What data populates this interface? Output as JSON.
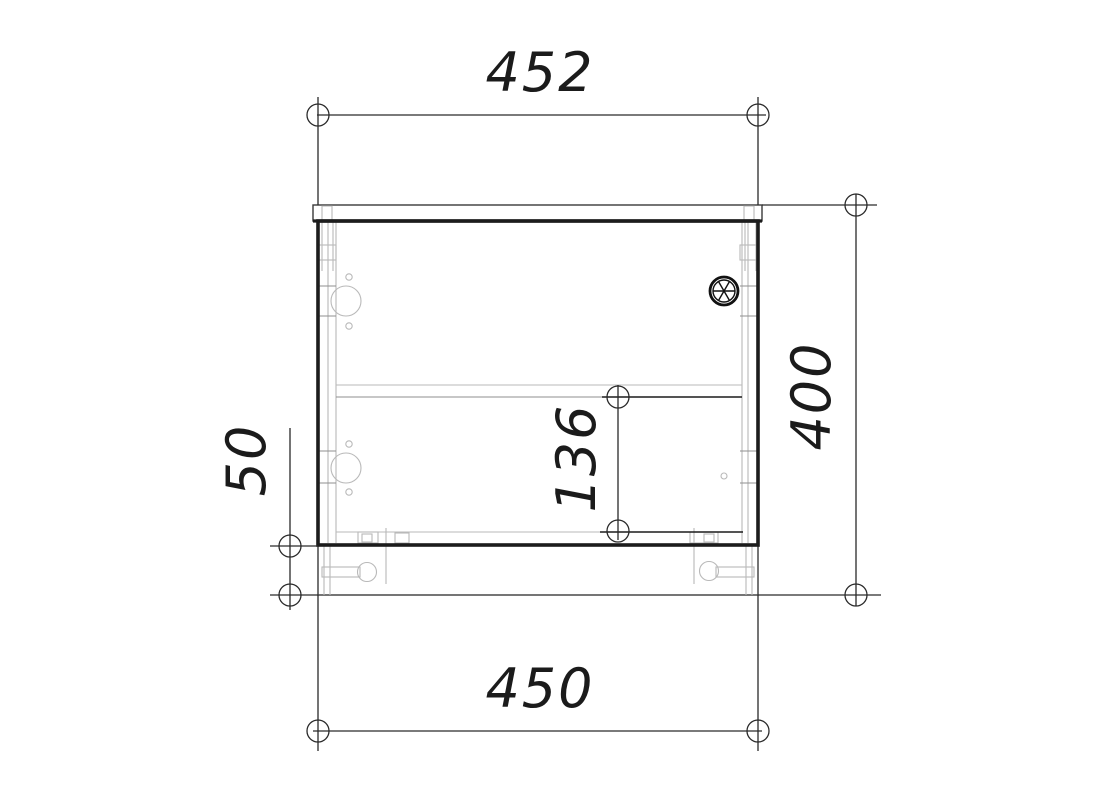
{
  "drawing": {
    "title": "cabinet-technical-drawing",
    "dimension_labels": {
      "top_width": "452",
      "overall_height": "400",
      "bottom_width": "450",
      "shelf_to_bottom": "136",
      "plinth_height": "50"
    },
    "colors": {
      "background": "#ffffff",
      "outline": "#1c1c1c",
      "dimension_line": "#2a2a2a",
      "detail_line": "#b9b9b9",
      "mid_line": "#8f8f8f"
    },
    "symbols": {
      "cable_gland": "cable-gland-icon",
      "hinge_top": "hinge-cup-top",
      "hinge_bottom": "hinge-cup-bottom",
      "foot_left": "adjustable-foot-left",
      "foot_right": "adjustable-foot-right"
    }
  }
}
